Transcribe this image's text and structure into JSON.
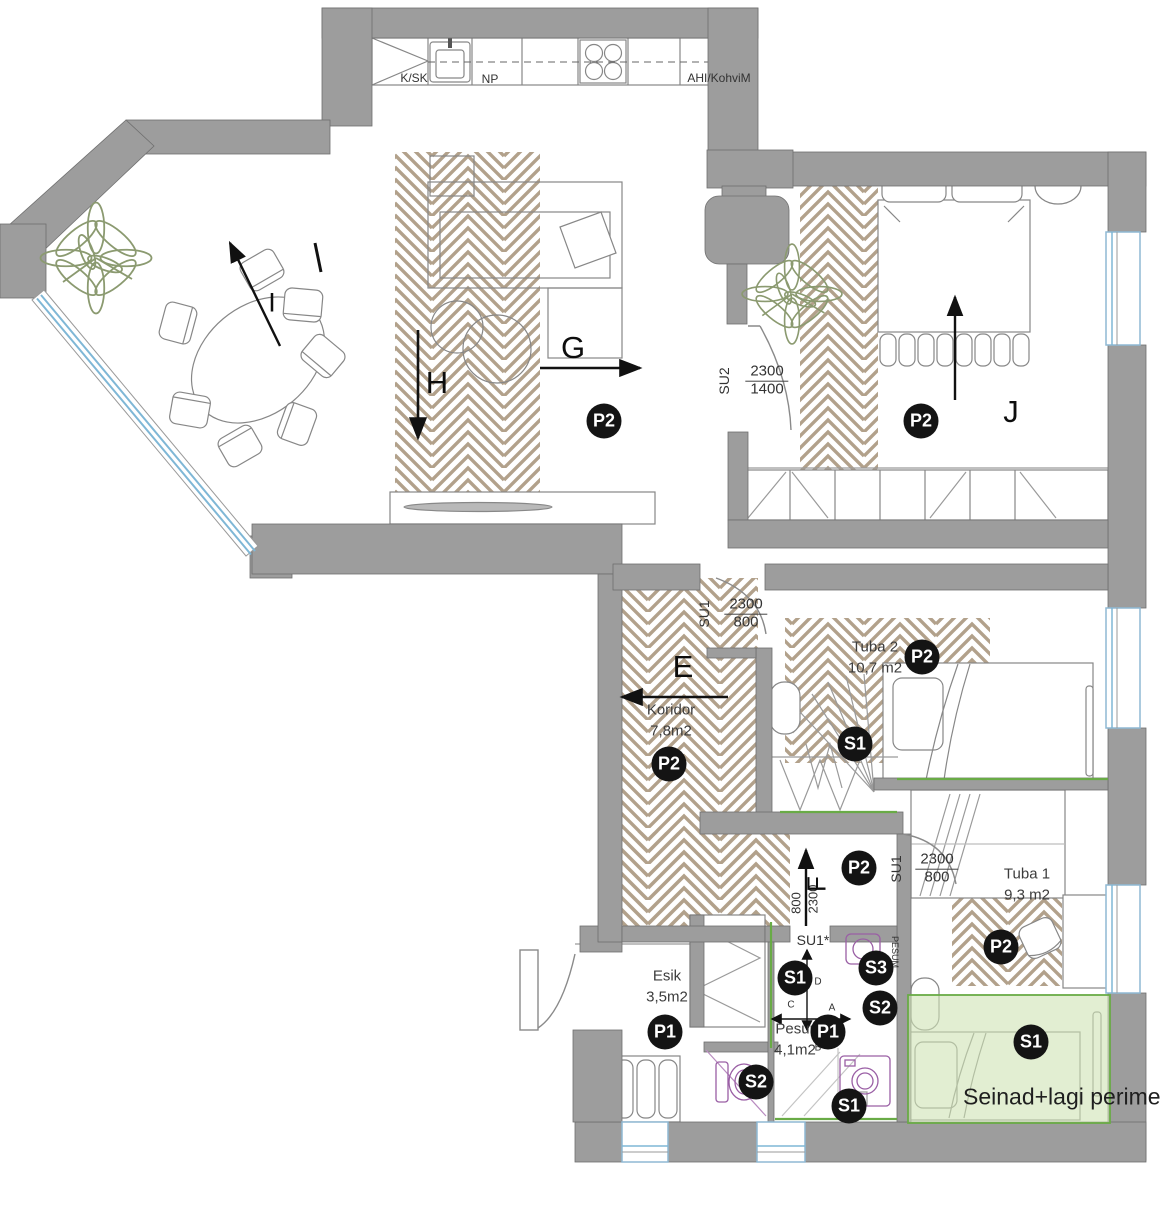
{
  "colors": {
    "wall": "#9d9d9d",
    "wall_outline": "#6f6f6f",
    "hatch": "#b2a18b",
    "green_accent": "#69ab46",
    "green_fill": "#cfe3b4",
    "window_blue": "#7fb7d6",
    "fixture_purple": "#9a5fa5",
    "marker_bg": "#141414",
    "marker_text": "#ffffff"
  },
  "note": {
    "text": "Seinad+lagi perime"
  },
  "markers": [
    {
      "label": "P2",
      "x": 604,
      "y": 421
    },
    {
      "label": "P2",
      "x": 921,
      "y": 421
    },
    {
      "label": "P2",
      "x": 922,
      "y": 657
    },
    {
      "label": "S1",
      "x": 855,
      "y": 744
    },
    {
      "label": "P2",
      "x": 669,
      "y": 764
    },
    {
      "label": "P2",
      "x": 859,
      "y": 868
    },
    {
      "label": "P2",
      "x": 1001,
      "y": 947
    },
    {
      "label": "S1",
      "x": 795,
      "y": 978
    },
    {
      "label": "S3",
      "x": 876,
      "y": 968
    },
    {
      "label": "S2",
      "x": 880,
      "y": 1008
    },
    {
      "label": "P1",
      "x": 828,
      "y": 1032
    },
    {
      "label": "P1",
      "x": 665,
      "y": 1032
    },
    {
      "label": "S2",
      "x": 756,
      "y": 1082
    },
    {
      "label": "S1",
      "x": 849,
      "y": 1106
    },
    {
      "label": "S1",
      "x": 1031,
      "y": 1042
    }
  ],
  "section_labels": [
    {
      "label": "I",
      "x": 272,
      "y": 303,
      "size": 27,
      "rot": 0
    },
    {
      "label": "G",
      "x": 573,
      "y": 348,
      "size": 31,
      "rot": 0
    },
    {
      "label": "H",
      "x": 437,
      "y": 383,
      "size": 31,
      "rot": 0
    },
    {
      "label": "E",
      "x": 683,
      "y": 667,
      "size": 31,
      "rot": 0
    },
    {
      "label": "F",
      "x": 817,
      "y": 884,
      "size": 26,
      "rot": -90
    },
    {
      "label": "J",
      "x": 1011,
      "y": 412,
      "size": 31,
      "rot": 0
    }
  ],
  "room_labels": [
    {
      "name": "Tuba 2",
      "area": "10,7 m2",
      "x": 875,
      "y": 658
    },
    {
      "name": "Koridor",
      "area": "7,8m2",
      "x": 671,
      "y": 721
    },
    {
      "name": "Tuba 1",
      "area": "9,3 m2",
      "x": 1027,
      "y": 885
    },
    {
      "name": "Esik",
      "area": "3,5m2",
      "x": 667,
      "y": 987
    },
    {
      "name": "Pesur",
      "area": "4,1m2",
      "x": 795,
      "y": 1040
    }
  ],
  "door_labels": [
    {
      "code": "SU2",
      "dim_top": "2300",
      "dim_bottom": "1400",
      "code_x": 724,
      "code_y": 381,
      "dim_x": 767,
      "dim_y": 381
    },
    {
      "code": "SU1",
      "dim_top": "2300",
      "dim_bottom": "800",
      "code_x": 704,
      "code_y": 614,
      "dim_x": 746,
      "dim_y": 614
    },
    {
      "code": "SU1",
      "dim_top": "2300",
      "dim_bottom": "800",
      "code_x": 896,
      "code_y": 869,
      "dim_x": 937,
      "dim_y": 869
    }
  ],
  "rotated_dims": [
    {
      "text": "800",
      "x": 796,
      "y": 903
    },
    {
      "text": "2300",
      "x": 813,
      "y": 899
    }
  ],
  "small_labels": [
    {
      "text": "K/SK",
      "x": 414,
      "y": 78,
      "size": 12
    },
    {
      "text": "NP",
      "x": 490,
      "y": 79,
      "size": 12
    },
    {
      "text": "AHI/KohviM",
      "x": 719,
      "y": 78,
      "size": 12
    },
    {
      "text": "SU1*",
      "x": 813,
      "y": 940,
      "size": 14
    },
    {
      "text": "PESUM",
      "x": 895,
      "y": 952,
      "size": 9,
      "rot": 90
    },
    {
      "text": "D",
      "x": 818,
      "y": 982,
      "size": 10
    },
    {
      "text": "C",
      "x": 791,
      "y": 1005,
      "size": 10
    },
    {
      "text": "A",
      "x": 832,
      "y": 1008,
      "size": 10
    },
    {
      "text": "B",
      "x": 818,
      "y": 1048,
      "size": 10
    }
  ]
}
